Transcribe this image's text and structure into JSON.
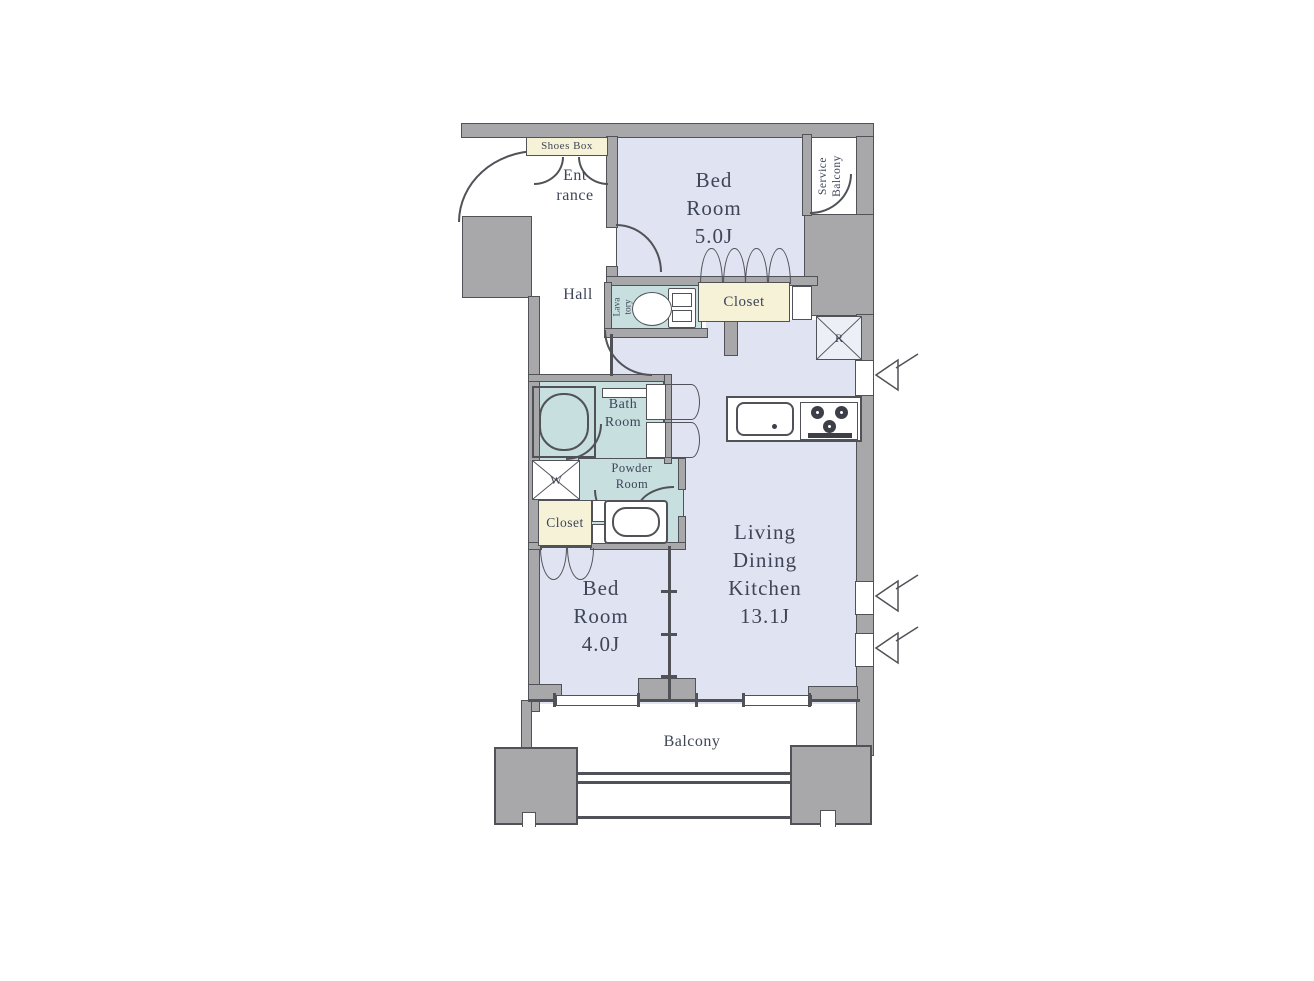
{
  "colors": {
    "wall": "#a8a8ab",
    "edge": "#515257",
    "room": "#e0e3f1",
    "wet": "#c8dfdf",
    "cream": "#f6f2d8",
    "text": "#3e4557"
  },
  "plan": {
    "bedroom5": {
      "line1": "Bed",
      "line2": "Room",
      "area": "5.0J"
    },
    "bedroom4": {
      "line1": "Bed",
      "line2": "Room",
      "area": "4.0J"
    },
    "ldk": {
      "line1": "Living",
      "line2": "Dining",
      "line3": "Kitchen",
      "area": "13.1J"
    },
    "balcony": "Balcony",
    "service_balcony": {
      "line1": "Service",
      "line2": "Balcony"
    },
    "entrance": {
      "line1": "Ent",
      "line2": "rance"
    },
    "hall": "Hall",
    "lavatory": {
      "line1": "Lava",
      "line2": "tory"
    },
    "bath": {
      "line1": "Bath",
      "line2": "Room"
    },
    "powder": {
      "line1": "Powder",
      "line2": "Room"
    },
    "closet_top": "Closet",
    "closet_bottom": "Closet",
    "shoes_box": "Shoes Box",
    "washer_symbol": "W",
    "fridge_symbol": "R"
  }
}
